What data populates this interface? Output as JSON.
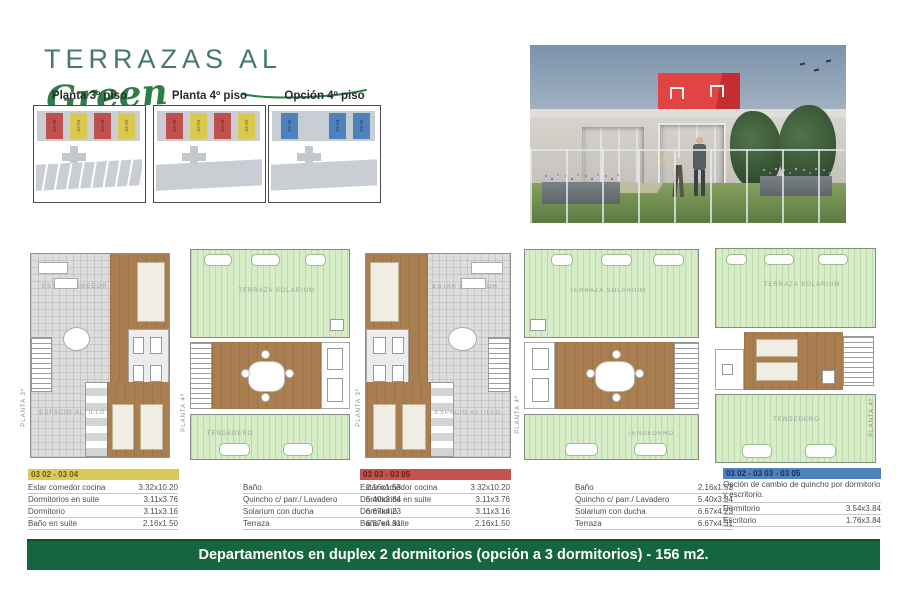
{
  "title": {
    "main": "TERRAZAS AL",
    "script": "Green"
  },
  "mini_plans": [
    {
      "label": "Planta 3º piso",
      "units": [
        {
          "id": "03 05",
          "color": "red",
          "slot": "s0"
        },
        {
          "id": "03 04",
          "color": "yellow",
          "slot": "s1"
        },
        {
          "id": "03 03",
          "color": "red",
          "slot": "s2"
        },
        {
          "id": "03 02",
          "color": "yellow",
          "slot": "s3"
        }
      ]
    },
    {
      "label": "Planta 4º piso",
      "units": [
        {
          "id": "03 05",
          "color": "red",
          "slot": "s0"
        },
        {
          "id": "03 04",
          "color": "yellow",
          "slot": "s1"
        },
        {
          "id": "03 03",
          "color": "red",
          "slot": "s2"
        },
        {
          "id": "03 02",
          "color": "yellow",
          "slot": "s3"
        }
      ]
    },
    {
      "label": "Opción 4º piso",
      "units": [
        {
          "id": "03 05",
          "color": "blue",
          "slot": "s0"
        },
        {
          "id": "03 03",
          "color": "blue",
          "slot": "s2"
        },
        {
          "id": "03 02",
          "color": "blue",
          "slot": "s3"
        }
      ]
    }
  ],
  "floor_plans": {
    "apartment_labels": {
      "living": "ESTAR COMEDOR",
      "altillo": "ESPACIO ALTILLO"
    },
    "terrace_labels": {
      "solarium": "TERRAZA SOLARIUM",
      "tendedero": "TENDEDERO"
    },
    "side_labels": {
      "p3": "PLANTA 3º",
      "p4": "PLANTA 4º"
    }
  },
  "tables": [
    {
      "header": "03 02 - 03 04",
      "left_rows": [
        {
          "label": "Estar comedor cocina",
          "value": "3.32x10.20"
        },
        {
          "label": "Dormitorios en suite",
          "value": "3.11x3.76"
        },
        {
          "label": "Dormitorio",
          "value": "3.11x3.16"
        },
        {
          "label": "Baño en suite",
          "value": "2.16x1.50"
        }
      ],
      "right_rows": [
        {
          "label": "Baño",
          "value": "2.16x1.53"
        },
        {
          "label": "Quincho c/ parr./ Lavadero",
          "value": "5.40x3.84"
        },
        {
          "label": "Solarium con ducha",
          "value": "6.67x4.23"
        },
        {
          "label": "Terraza",
          "value": "6.67x4.31"
        }
      ]
    },
    {
      "header": "03 03 - 03 05",
      "left_rows": [
        {
          "label": "Estar comedor cocina",
          "value": "3.32x10.20"
        },
        {
          "label": "Dormitorios en suite",
          "value": "3.11x3.76"
        },
        {
          "label": "Dormitorio",
          "value": "3.11x3.16"
        },
        {
          "label": "Baño en suite",
          "value": "2.16x1.50"
        }
      ],
      "right_rows": [
        {
          "label": "Baño",
          "value": "2.16x1.53"
        },
        {
          "label": "Quincho c/ parr./ Lavadero",
          "value": "5.40x3.84"
        },
        {
          "label": "Solarium con ducha",
          "value": "6.67x4.23"
        },
        {
          "label": "Terraza",
          "value": "6.67x4.31"
        }
      ]
    },
    {
      "header": "03 02 - 03 03 - 03 05",
      "note": "Opción de cambio de quincho por dormitorio y escritorio.",
      "rows": [
        {
          "label": "Dormitorio",
          "value": "3.54x3.84"
        },
        {
          "label": "Escritorio",
          "value": "1.76x3.84"
        }
      ]
    }
  ],
  "banner": {
    "text": "Departamentos en duplex 2 dormitorios (opción a 3 dormitorios) - 156 m2."
  },
  "colors": {
    "unit_red": "#c0504d",
    "unit_yellow": "#d9c94f",
    "unit_blue": "#4f81bd",
    "banner_green": "#15663e",
    "title_green": "#2e7d49",
    "roof_red": "#e24343"
  }
}
